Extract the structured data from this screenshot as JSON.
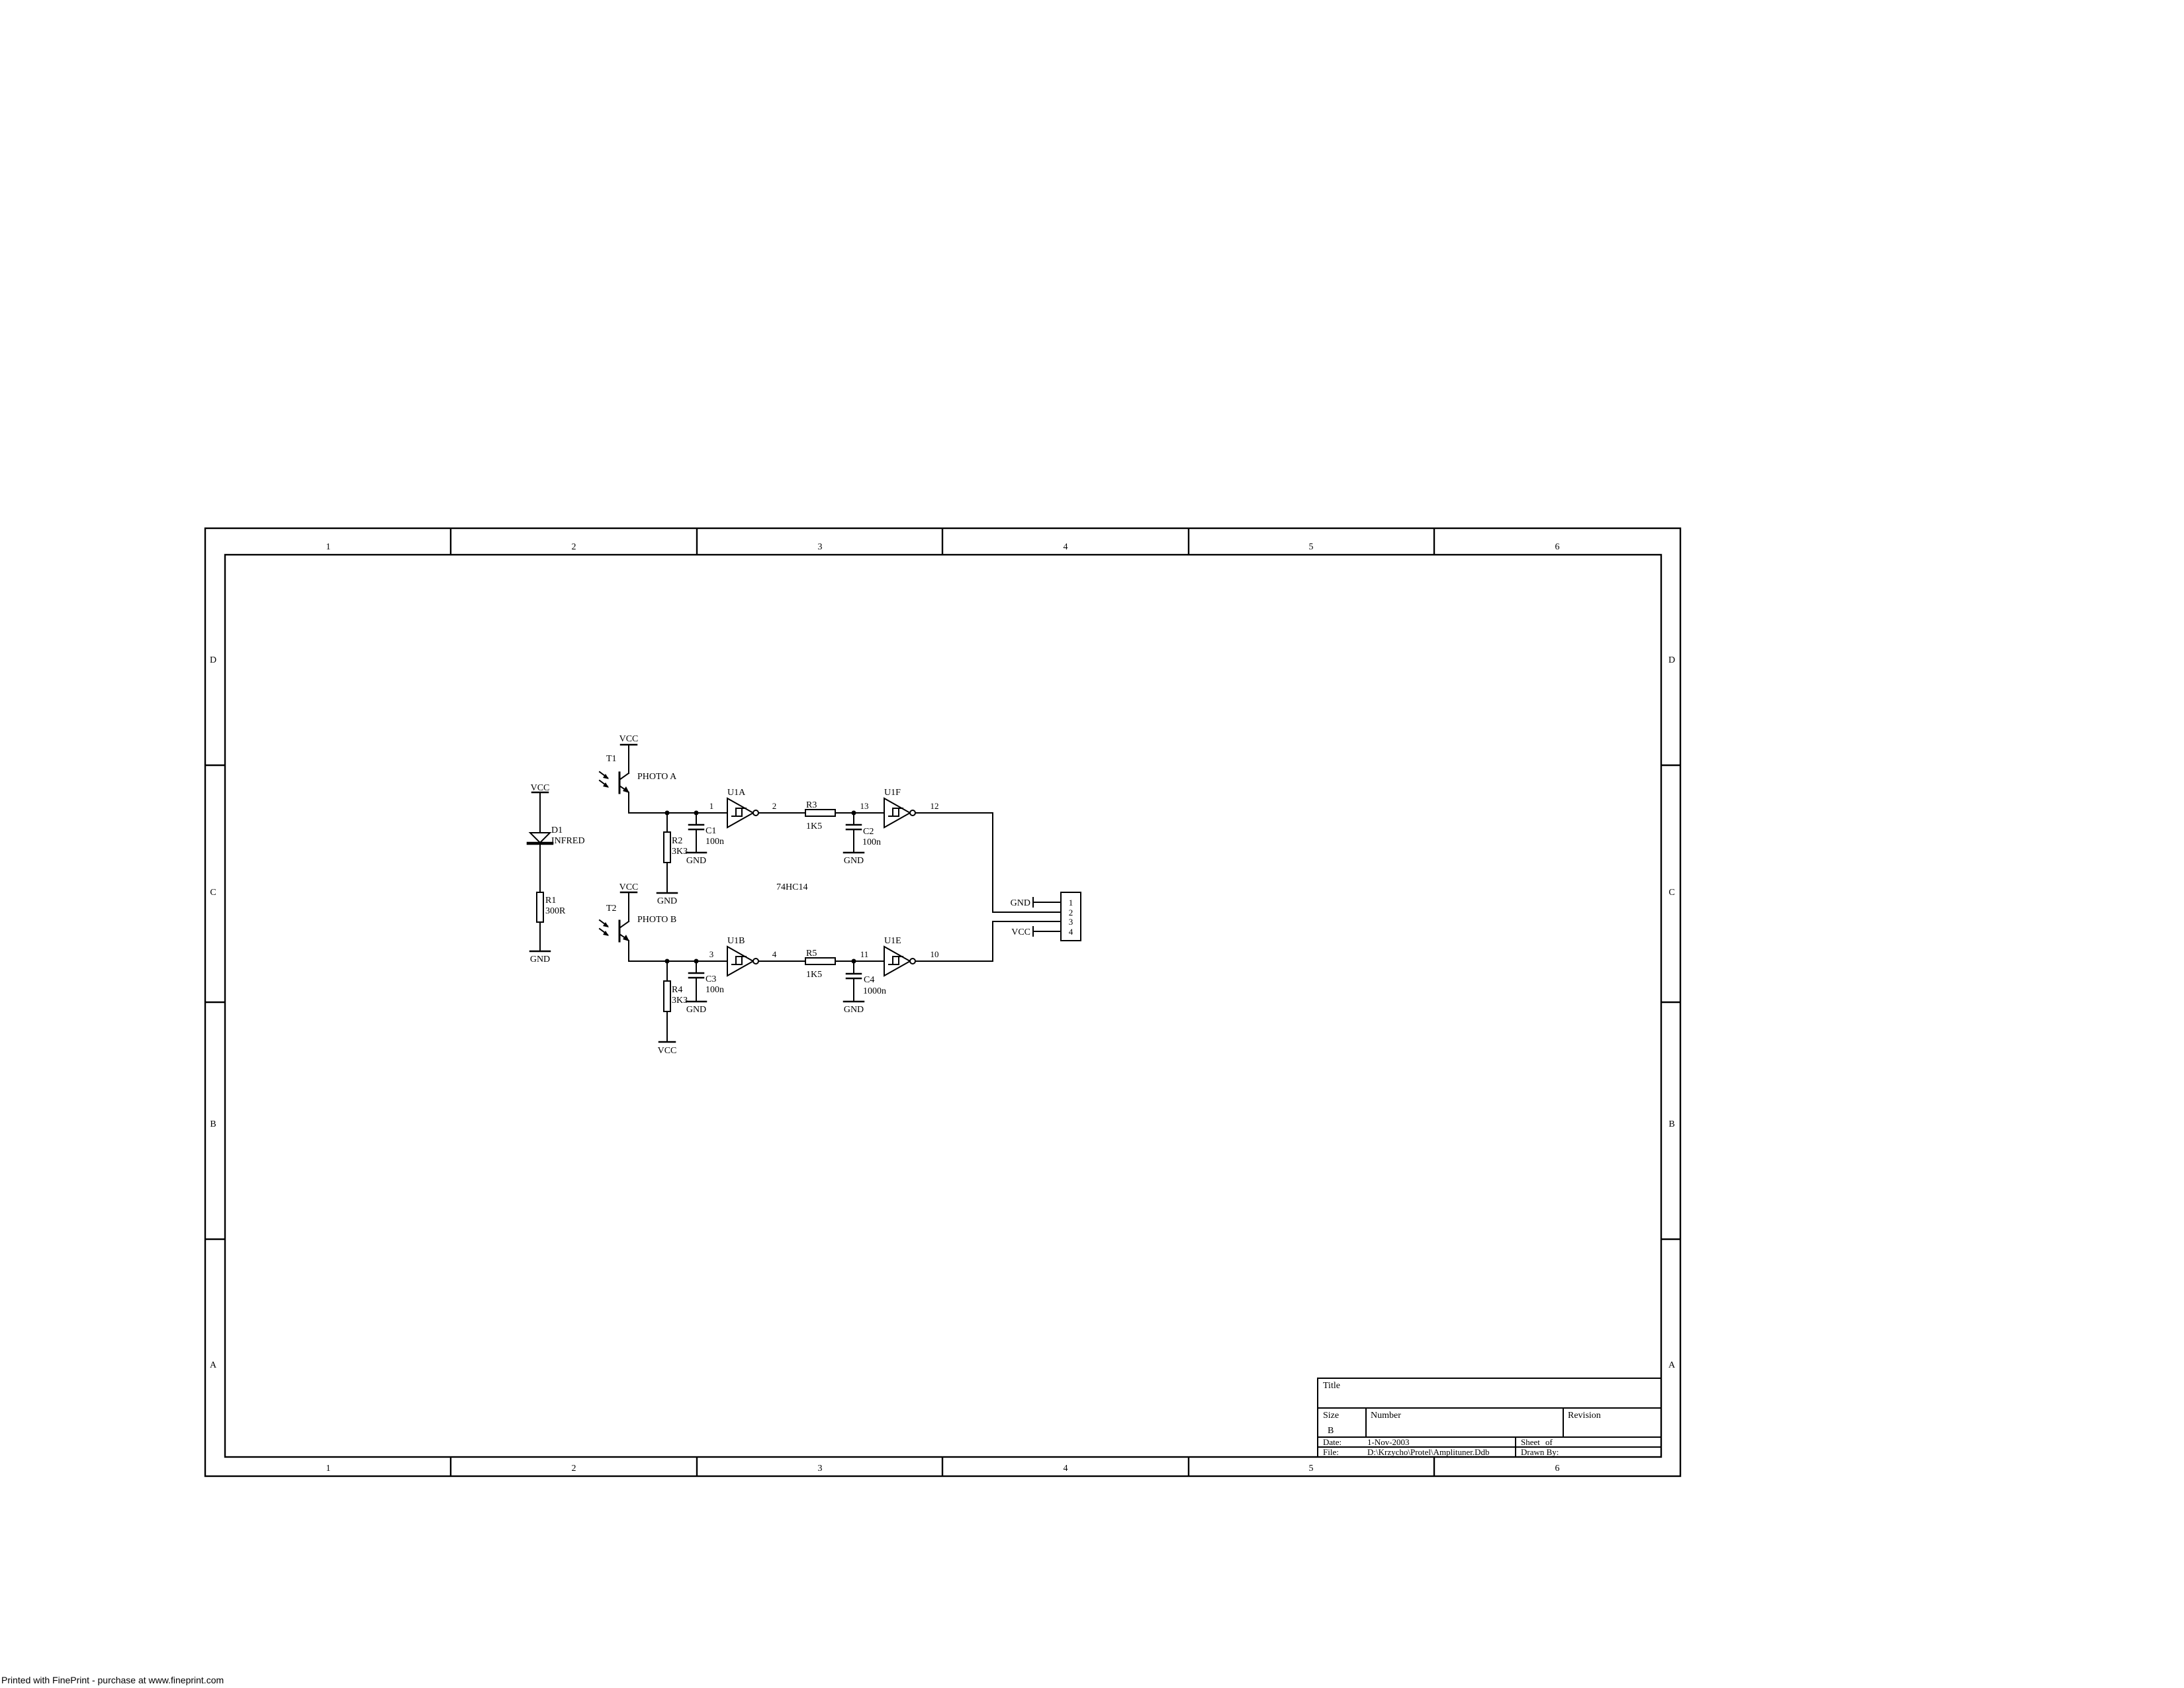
{
  "page": {
    "fineprint_notice": "Printed with FinePrint - purchase at www.fineprint.com"
  },
  "sheet": {
    "column_labels": [
      "1",
      "2",
      "3",
      "4",
      "5",
      "6"
    ],
    "row_labels": [
      "D",
      "C",
      "B",
      "A"
    ]
  },
  "title_block": {
    "title_label": "Title",
    "size_label": "Size",
    "size_value": "B",
    "number_label": "Number",
    "revision_label": "Revision",
    "date_label": "Date:",
    "date_value": "1-Nov-2003",
    "sheet_label": "Sheet",
    "of_label": "of",
    "file_label": "File:",
    "file_value": "D:\\Krzycho\\Protel\\Amplituner.Ddb",
    "drawn_by_label": "Drawn By:"
  },
  "power": {
    "vcc": "VCC",
    "gnd": "GND"
  },
  "ic": {
    "name": "74HC14"
  },
  "components": {
    "d1": {
      "ref": "D1",
      "value": "INFRED"
    },
    "r1": {
      "ref": "R1",
      "value": "300R"
    },
    "r2": {
      "ref": "R2",
      "value": "3K3"
    },
    "r3": {
      "ref": "R3",
      "value": "1K5"
    },
    "r4": {
      "ref": "R4",
      "value": "3K3"
    },
    "r5": {
      "ref": "R5",
      "value": "1K5"
    },
    "c1": {
      "ref": "C1",
      "value": "100n"
    },
    "c2": {
      "ref": "C2",
      "value": "100n"
    },
    "c3": {
      "ref": "C3",
      "value": "100n"
    },
    "c4": {
      "ref": "C4",
      "value": "1000n"
    },
    "t1": {
      "ref": "T1",
      "value": "PHOTO A"
    },
    "t2": {
      "ref": "T2",
      "value": "PHOTO B"
    },
    "u1a": {
      "ref": "U1A",
      "pin_in": "1",
      "pin_out": "2"
    },
    "u1f": {
      "ref": "U1F",
      "pin_in": "13",
      "pin_out": "12"
    },
    "u1b": {
      "ref": "U1B",
      "pin_in": "3",
      "pin_out": "4"
    },
    "u1e": {
      "ref": "U1E",
      "pin_in": "11",
      "pin_out": "10"
    }
  },
  "connector": {
    "pins": [
      "1",
      "2",
      "3",
      "4"
    ]
  }
}
